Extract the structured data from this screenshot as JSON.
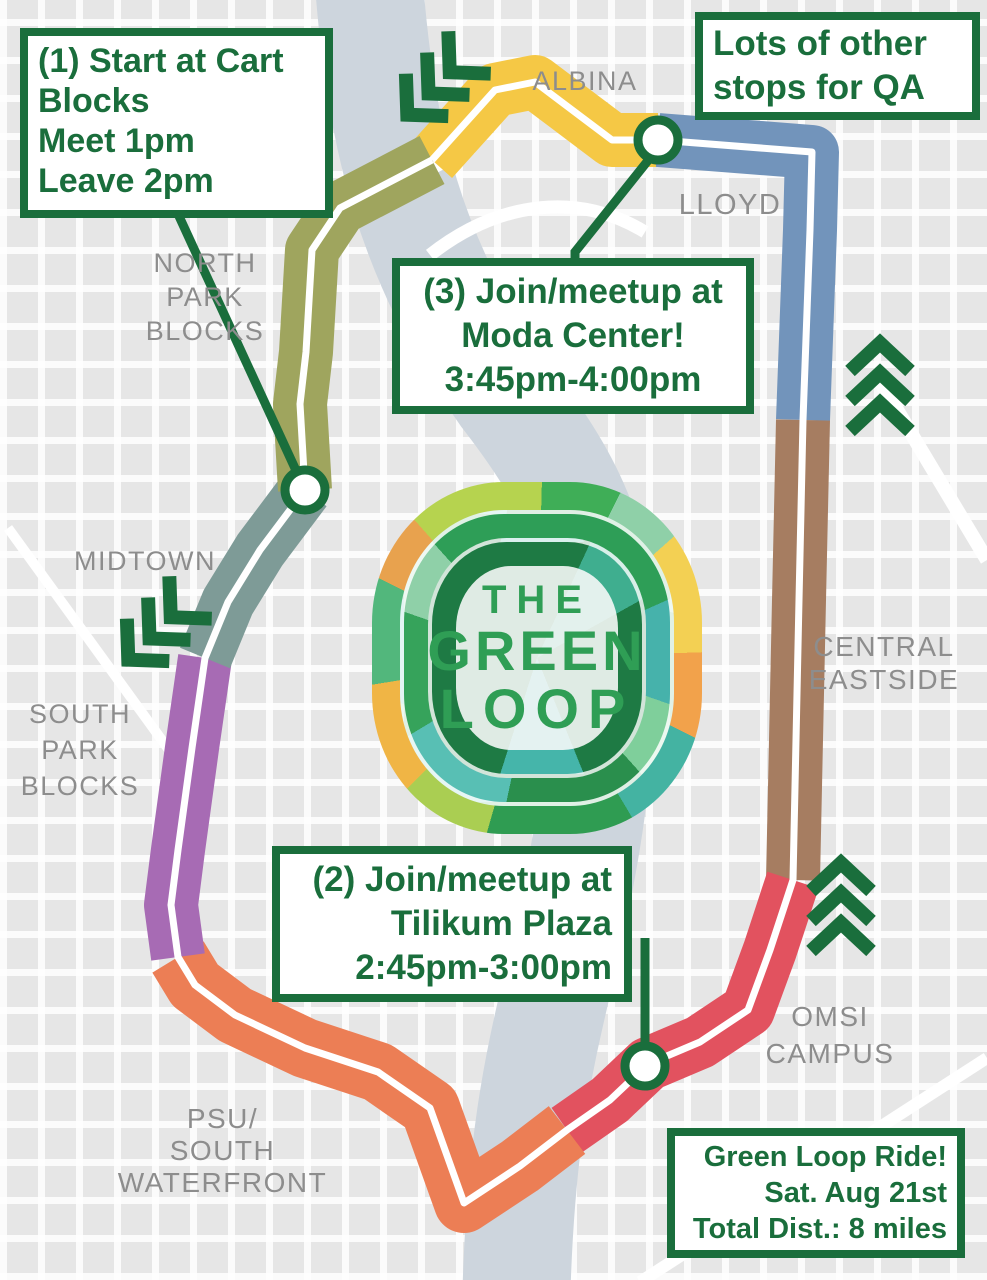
{
  "title": "The Green Loop – Green Loop Ride route map",
  "colors": {
    "dark_green": "#1A6E3C",
    "label_gray": "#8D8D8D",
    "river": "#CDD5DD",
    "centerline": "#FFFFFF",
    "street_white": "#FFFFFF"
  },
  "route": {
    "segments": [
      {
        "name": "Albina",
        "color": "#F5C845"
      },
      {
        "name": "Lloyd",
        "color": "#7294BB"
      },
      {
        "name": "Central Eastside",
        "color": "#A67D61"
      },
      {
        "name": "OMSI",
        "color": "#E2525F"
      },
      {
        "name": "PSU / South Waterfront",
        "color": "#EC7E55"
      },
      {
        "name": "South Park Blocks",
        "color": "#A76BB4"
      },
      {
        "name": "Midtown",
        "color": "#7E9B97"
      },
      {
        "name": "North Park Blocks",
        "color": "#9FA55E"
      }
    ],
    "stops": [
      {
        "id": "cart-blocks",
        "label": "Start at Cart Blocks"
      },
      {
        "id": "moda-center",
        "label": "Moda Center"
      },
      {
        "id": "tilikum-plaza",
        "label": "Tilikum Plaza"
      }
    ],
    "direction_arrow_groups": 4
  },
  "boxes": {
    "start": {
      "lines": [
        "(1) Start at Cart Blocks",
        "Meet 1pm",
        "Leave 2pm"
      ]
    },
    "qa": {
      "lines": [
        "Lots of other stops for QA"
      ]
    },
    "moda": {
      "lines": [
        "(3) Join/meetup at",
        "Moda Center!",
        "3:45pm-4:00pm"
      ]
    },
    "tilikum": {
      "lines": [
        "(2) Join/meetup at",
        "Tilikum Plaza",
        "2:45pm-3:00pm"
      ]
    },
    "info": {
      "lines": [
        "Green Loop Ride!",
        "Sat. Aug 21st",
        "Total Dist.: 8 miles"
      ]
    }
  },
  "regions": {
    "albina": {
      "lines": [
        "ALBINA"
      ]
    },
    "lloyd": {
      "lines": [
        "LLOYD"
      ]
    },
    "north_park_blocks": {
      "lines": [
        "NORTH",
        "PARK",
        "BLOCKS"
      ]
    },
    "midtown": {
      "lines": [
        "MIDTOWN"
      ]
    },
    "south_park_blocks": {
      "lines": [
        "SOUTH",
        "PARK",
        "BLOCKS"
      ]
    },
    "central_eastside": {
      "lines": [
        "CENTRAL",
        "EASTSIDE"
      ]
    },
    "omsi_campus": {
      "lines": [
        "OMSI",
        "CAMPUS"
      ]
    },
    "psu_south_waterfront": {
      "lines": [
        "PSU/",
        "SOUTH WATERFRONT"
      ]
    }
  },
  "logo": {
    "lines": [
      "THE",
      "GREEN",
      "LOOP"
    ]
  }
}
